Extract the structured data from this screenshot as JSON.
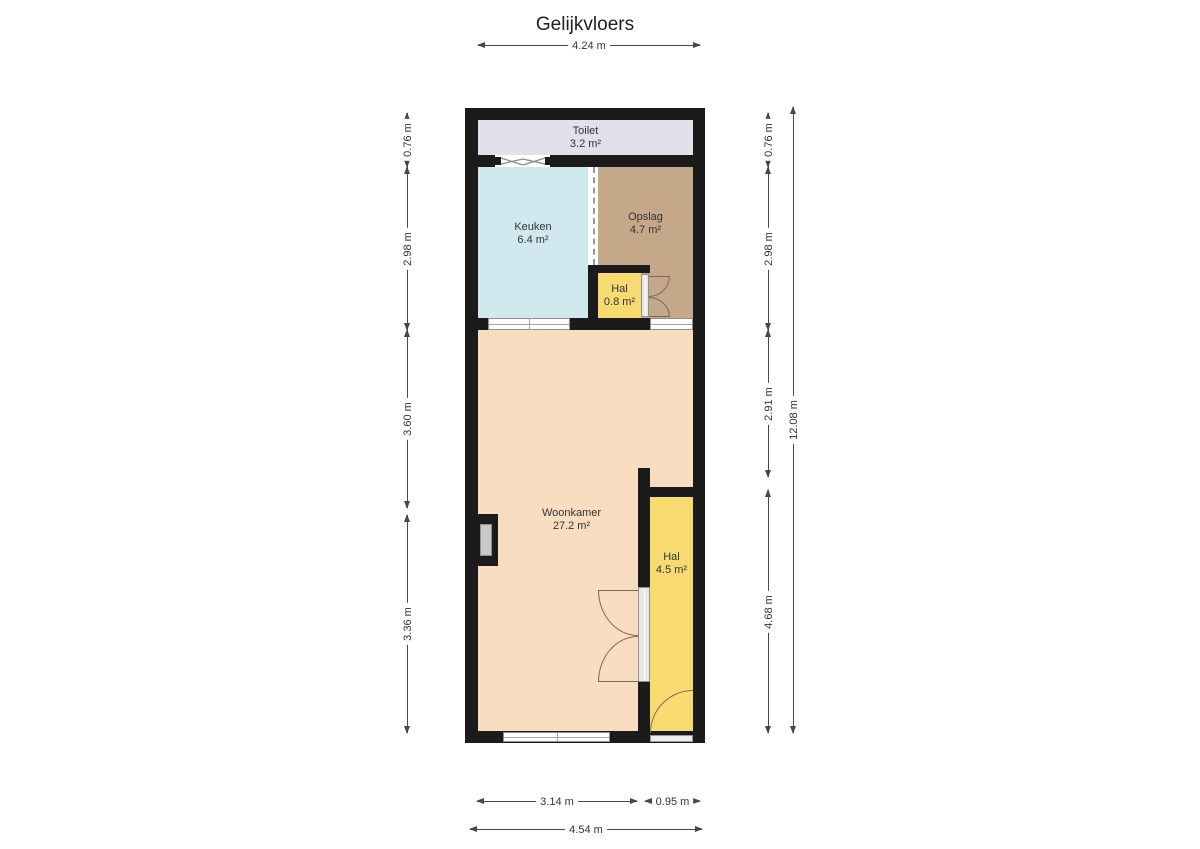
{
  "title": "Gelijkvloers",
  "rooms": [
    {
      "name": "Toilet",
      "area": "3.2 m²",
      "color": "#e0e1ea"
    },
    {
      "name": "Keuken",
      "area": "6.4 m²",
      "color": "#cfe9ef"
    },
    {
      "name": "Opslag",
      "area": "4.7 m²",
      "color": "#c5a88a"
    },
    {
      "name": "Hal",
      "area": "0.8 m²",
      "color": "#f8db70"
    },
    {
      "name": "Woonkamer",
      "area": "27.2 m²",
      "color": "#f9ddc1"
    },
    {
      "name": "Hal",
      "area": "4.5 m²",
      "color": "#f8db70"
    }
  ],
  "dimensions": {
    "top": "4.24 m",
    "bottom_inner_left": "3.14 m",
    "bottom_inner_right": "0.95 m",
    "bottom_total": "4.54 m",
    "left": [
      "0.76 m",
      "2.98 m",
      "3.60 m",
      "3.36 m"
    ],
    "right": [
      "0.76 m",
      "2.98 m",
      "2.91 m",
      "4.68 m"
    ],
    "right_total": "12.08 m"
  },
  "colors": {
    "wall": "#1b1b1b",
    "dimension_line": "#474747",
    "door_arc": "#7a6a55",
    "window_fill": "#ffffff",
    "background": "#ffffff"
  }
}
